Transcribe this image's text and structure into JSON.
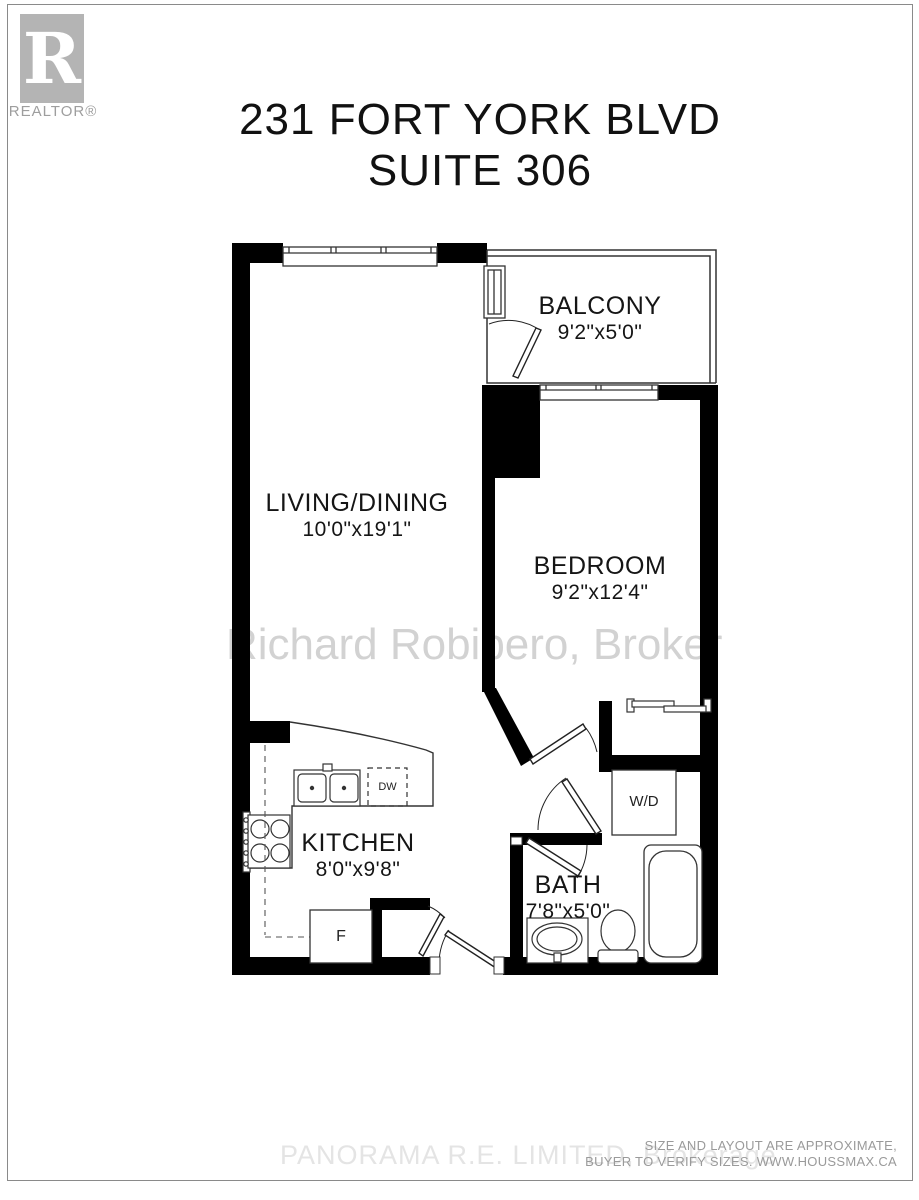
{
  "logo": {
    "r_letter": "R",
    "realtor_text": "REALTOR®"
  },
  "title": {
    "line1": "231 FORT YORK BLVD",
    "line2": "SUITE 306"
  },
  "rooms": {
    "balcony": {
      "name": "BALCONY",
      "dims": "9'2\"x5'0\""
    },
    "living_dining": {
      "name": "LIVING/DINING",
      "dims": "10'0\"x19'1\""
    },
    "bedroom": {
      "name": "BEDROOM",
      "dims": "9'2\"x12'4\""
    },
    "kitchen": {
      "name": "KITCHEN",
      "dims": "8'0\"x9'8\""
    },
    "bath": {
      "name": "BATH",
      "dims": "7'8\"x5'0\""
    }
  },
  "appliances": {
    "washer_dryer": "W/D",
    "dishwasher": "DW",
    "fridge": "F"
  },
  "watermarks": {
    "broker": "Richard Robibero, Broker",
    "brokerage": "PANORAMA R.E. LIMITED, Brokerage"
  },
  "disclaimer": {
    "line1": "SIZE AND LAYOUT ARE APPROXIMATE,",
    "line2": "BUYER TO VERIFY SIZES. WWW.HOUSSMAX.CA"
  },
  "colors": {
    "wall": "#000000",
    "thin_line": "#333333",
    "logo_gray": "#b4b4b4",
    "watermark_gray": "#d2d2d2",
    "disclaimer_gray": "#9a9a9a"
  }
}
